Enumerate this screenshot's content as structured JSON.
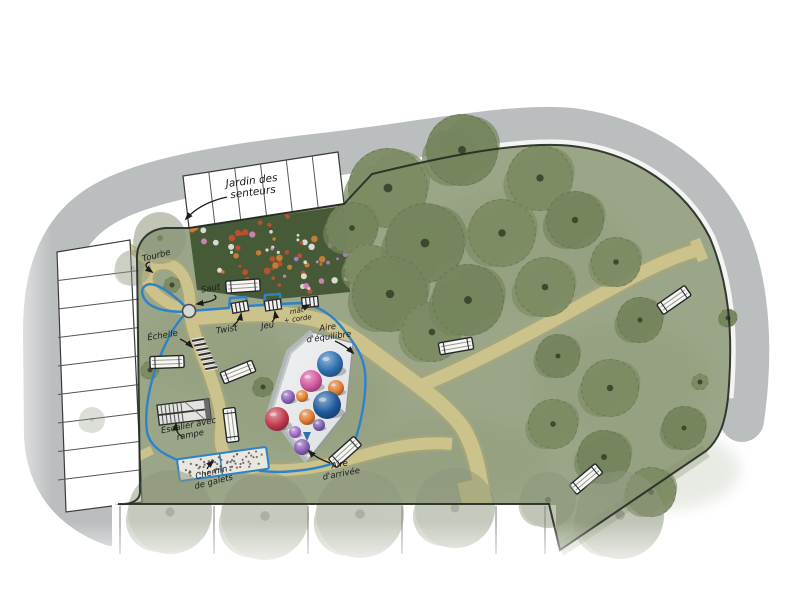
{
  "plan": {
    "kind": "hand-drawn landscape site plan of a public garden playground",
    "language": "French"
  },
  "colors": {
    "background": "#ffffff",
    "road": "#b7bbbc",
    "lawn": "#9ba587",
    "lawn_shade": "#84926f",
    "path": "#ccc28b",
    "path_edge": "#b3a974",
    "garden_bed": "#475a38",
    "plaza": "#e9eaeb",
    "plaza_shadow": "#b9bec2",
    "route_blue": "#2e82c6",
    "boundary": "#242a22",
    "tree": "#7d8b64",
    "tree_alt": "#75845c",
    "tree_faded": "#8e977d",
    "tree_dot": "#36422a",
    "bench_fill": "#f7f6f2",
    "ink": "#1c1c1c",
    "stall_fill": "#ffffff",
    "stall_line": "#555555"
  },
  "labels": [
    {
      "id": "jardin-des-senteurs",
      "lines": [
        "Jardin des",
        "senteurs"
      ],
      "x": 252,
      "y": 184,
      "rot": -7,
      "size": 10.5,
      "arrow": [
        227,
        197,
        200,
        203,
        186,
        219
      ]
    },
    {
      "id": "tourbe",
      "lines": [
        "Tourbe"
      ],
      "x": 157,
      "y": 258,
      "rot": -14,
      "size": 8.5,
      "arrow": [
        150,
        262,
        141,
        264,
        152,
        272
      ]
    },
    {
      "id": "saut",
      "lines": [
        "Saut"
      ],
      "x": 211,
      "y": 291,
      "rot": -10,
      "size": 8.5,
      "arrow": [
        214,
        295,
        222,
        300,
        197,
        304
      ]
    },
    {
      "id": "echelle",
      "lines": [
        "Échelle"
      ],
      "x": 163,
      "y": 338,
      "rot": -9,
      "size": 8.5,
      "arrow": [
        180,
        339,
        188,
        343,
        192,
        347
      ]
    },
    {
      "id": "twist",
      "lines": [
        "Twist"
      ],
      "x": 227,
      "y": 332,
      "rot": -9,
      "size": 8.5,
      "arrow": [
        233,
        326,
        240,
        320,
        241,
        314
      ]
    },
    {
      "id": "jeu",
      "lines": [
        "Jeu"
      ],
      "x": 268,
      "y": 328,
      "rot": -9,
      "size": 8.5,
      "arrow": [
        272,
        322,
        276,
        318,
        275,
        312
      ]
    },
    {
      "id": "mat-corde",
      "lines": [
        "mât",
        "+ corde"
      ],
      "x": 297,
      "y": 313,
      "rot": -8,
      "size": 7,
      "arrow": [
        303,
        308,
        307,
        306,
        309,
        305
      ]
    },
    {
      "id": "aire-equilibre",
      "lines": [
        "Aire",
        "d'équilibre"
      ],
      "x": 328,
      "y": 330,
      "rot": -8,
      "size": 8.5,
      "arrow": [
        335,
        341,
        346,
        346,
        353,
        353
      ]
    },
    {
      "id": "escalier-rampe",
      "lines": [
        "Escalier avec",
        "rampe"
      ],
      "x": 189,
      "y": 428,
      "rot": -11,
      "size": 8.5,
      "arrow": [
        183,
        437,
        175,
        433,
        176,
        424
      ]
    },
    {
      "id": "chemin-galets",
      "lines": [
        "Chemin",
        "de galets"
      ],
      "x": 212,
      "y": 475,
      "rot": -14,
      "size": 8.5,
      "arrow": [
        207,
        469,
        209,
        465,
        213,
        461
      ]
    },
    {
      "id": "aire-arrivee",
      "lines": [
        "Aire",
        "d'arrivée"
      ],
      "x": 340,
      "y": 467,
      "rot": -11,
      "size": 8.5,
      "arrow": [
        330,
        463,
        316,
        458,
        309,
        451
      ]
    }
  ],
  "trees": {
    "main": [
      [
        388,
        188,
        40
      ],
      [
        462,
        150,
        36
      ],
      [
        540,
        178,
        33
      ],
      [
        352,
        228,
        26
      ],
      [
        368,
        268,
        24
      ],
      [
        425,
        243,
        40
      ],
      [
        502,
        233,
        34
      ],
      [
        575,
        220,
        29
      ],
      [
        616,
        262,
        25
      ],
      [
        390,
        294,
        38
      ],
      [
        432,
        332,
        30
      ],
      [
        468,
        300,
        36
      ],
      [
        545,
        287,
        30
      ],
      [
        640,
        320,
        23
      ],
      [
        610,
        388,
        29
      ],
      [
        558,
        356,
        22
      ],
      [
        553,
        424,
        25
      ],
      [
        604,
        457,
        27
      ],
      [
        651,
        492,
        25
      ],
      [
        684,
        428,
        22
      ],
      [
        172,
        285,
        8
      ],
      [
        263,
        387,
        10
      ],
      [
        150,
        370,
        9
      ],
      [
        728,
        318,
        9
      ],
      [
        700,
        382,
        8
      ]
    ],
    "faded": [
      [
        160,
        238,
        26,
        0.55
      ],
      [
        133,
        268,
        18,
        0.45
      ],
      [
        92,
        420,
        13,
        0.3
      ],
      [
        170,
        512,
        42,
        0.5
      ],
      [
        265,
        516,
        44,
        0.5
      ],
      [
        360,
        514,
        44,
        0.5
      ],
      [
        455,
        508,
        40,
        0.5
      ],
      [
        548,
        500,
        28,
        0.55
      ],
      [
        620,
        515,
        44,
        0.55
      ]
    ]
  },
  "benches": [
    [
      243,
      286,
      -4
    ],
    [
      167,
      362,
      -2
    ],
    [
      238,
      372,
      -22
    ],
    [
      231,
      425,
      83
    ],
    [
      345,
      452,
      -42
    ],
    [
      456,
      346,
      -10
    ],
    [
      674,
      300,
      -35
    ],
    [
      586,
      479,
      -40
    ]
  ],
  "domes": [
    {
      "x": 330,
      "y": 364,
      "r": 13,
      "color": "#2f6fb0"
    },
    {
      "x": 311,
      "y": 381,
      "r": 11,
      "color": "#d4579e"
    },
    {
      "x": 288,
      "y": 397,
      "r": 7,
      "color": "#8a63b5"
    },
    {
      "x": 302,
      "y": 396,
      "r": 6,
      "color": "#e0832f"
    },
    {
      "x": 336,
      "y": 388,
      "r": 8,
      "color": "#df7b35"
    },
    {
      "x": 327,
      "y": 405,
      "r": 14,
      "color": "#1f5a9e"
    },
    {
      "x": 277,
      "y": 419,
      "r": 12,
      "color": "#c43a50"
    },
    {
      "x": 307,
      "y": 417,
      "r": 8,
      "color": "#e07a33"
    },
    {
      "x": 319,
      "y": 425,
      "r": 6,
      "color": "#7d5fae"
    },
    {
      "x": 295,
      "y": 432,
      "r": 6,
      "color": "#a06cc4"
    },
    {
      "x": 302,
      "y": 447,
      "r": 8,
      "color": "#8a5fb7"
    }
  ],
  "play_items": [
    [
      240,
      307,
      -10
    ],
    [
      273,
      305,
      -8
    ],
    [
      310,
      302,
      -6
    ]
  ],
  "garden_dots": {
    "count": 75,
    "colors": [
      "#c94c32",
      "#e9e9e1",
      "#b07fd6",
      "#d687b8",
      "#d67e35"
    ]
  },
  "pebble_dots": {
    "count": 60,
    "color": "#5c5c5c"
  },
  "lawn_patches": [
    [
      300,
      400,
      90,
      50
    ],
    [
      520,
      250,
      110,
      60
    ],
    [
      620,
      380,
      90,
      55
    ],
    [
      210,
      350,
      70,
      45
    ],
    [
      450,
      460,
      100,
      40
    ],
    [
      660,
      470,
      80,
      40
    ],
    [
      300,
      220,
      80,
      40
    ]
  ]
}
